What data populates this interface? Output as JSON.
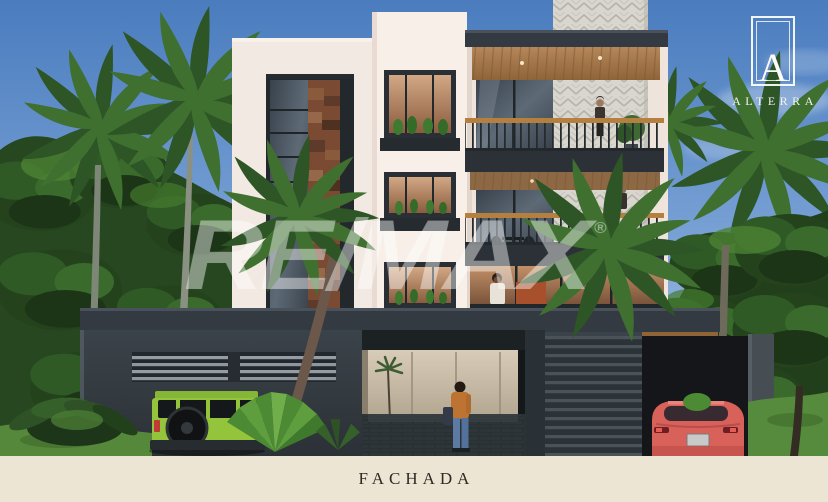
{
  "watermark": {
    "text": "RE/MAX",
    "registered": "®"
  },
  "logo": {
    "monogram": "A",
    "brand": "ALTERRA"
  },
  "footer": {
    "caption": "FACHADA"
  },
  "palette": {
    "sky_top": "#4a7cbe",
    "sky_mid": "#7ba3d6",
    "sky_bottom": "#bccfe9",
    "wall_white": "#f2e9e2",
    "wall_bright": "#f7efe8",
    "wall_right": "#efe5dd",
    "charcoal": "#333a41",
    "charcoal_deep": "#2b3137",
    "wood": "#a97c50",
    "wood_rail": "#b5803f",
    "stone": "#7a4a33",
    "herringbone": "#d9d6cf",
    "foliage_dark": "#24431d",
    "foliage_mid": "#2f5a26",
    "foliage_light": "#4c8234",
    "grass": "#55883b",
    "jeep_green": "#93c43c",
    "car_red": "#d8625a",
    "cream_band": "#ece5d3",
    "caption_color": "#2e2b24"
  }
}
